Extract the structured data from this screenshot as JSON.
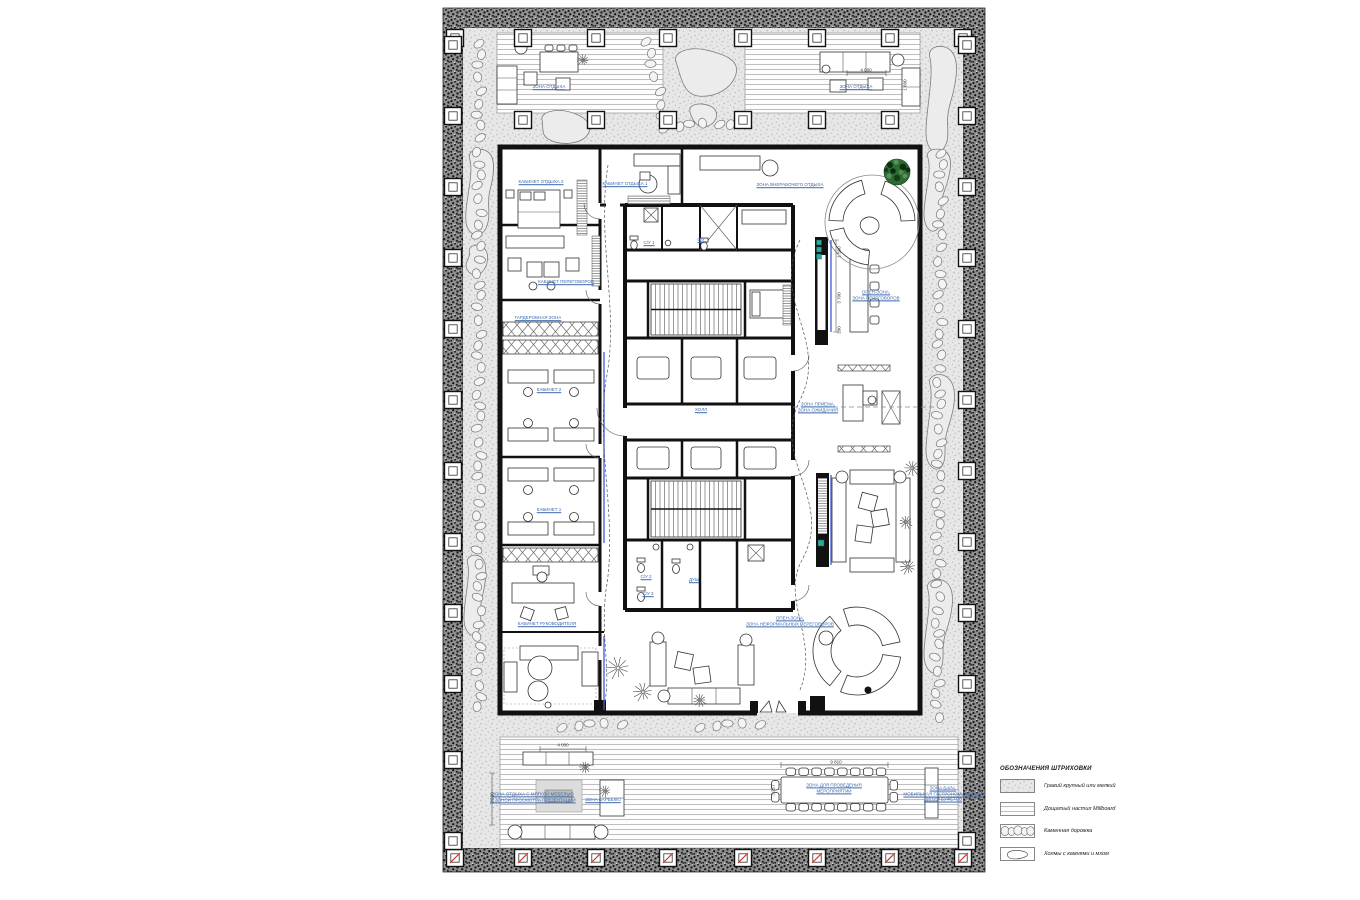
{
  "page": {
    "background": "#ffffff"
  },
  "colors": {
    "label_blue": "#3c69ae",
    "wall_black": "#111111",
    "tree_green": "#2c6b33",
    "column_mark_red": "#c3392b",
    "glass_blue": "#3f5bd6",
    "equipment_teal": "#2fa89a",
    "gravel_gray": "#e7e7e7",
    "band_dark": "#3a3a3a"
  },
  "legend": {
    "title": "ОБОЗНАЧЕНИЯ ШТРИХОВКИ",
    "items": [
      {
        "key": "gravel",
        "label": "Гравий крупный или мелкий"
      },
      {
        "key": "millboard",
        "label": "Дощатый настил Millboard"
      },
      {
        "key": "stone-path",
        "label": "Каменная дорожка"
      },
      {
        "key": "hills",
        "label": "Холмы с камнями и мхом"
      }
    ]
  },
  "plan": {
    "zone_labels": [
      {
        "text": "ЗОНА ОТДЫХА",
        "x": 549,
        "y": 87
      },
      {
        "text": "ЗОНА ОТДЫХА",
        "x": 856,
        "y": 87
      },
      {
        "text": "КАБИНЕТ ОТДЫХА 2",
        "x": 541,
        "y": 182
      },
      {
        "text": "КАБИНЕТ ОТДЫХА 1",
        "x": 625,
        "y": 184
      },
      {
        "text": "ЗОНА ВНЕРАБОЧЕГО ОТДЫХА",
        "x": 790,
        "y": 185
      },
      {
        "text": "КАБИНЕТ ПЕРЕГОВОРОВ",
        "x": 566,
        "y": 282
      },
      {
        "text": "ГАРДЕРОБНАЯ ЗОНА",
        "x": 538,
        "y": 318
      },
      {
        "text": "КАБИНЕТ 2",
        "x": 549,
        "y": 390
      },
      {
        "text": "КАБИНЕТ 1",
        "x": 549,
        "y": 510
      },
      {
        "text": "КАБИНЕТ РУКОВОДИТЕЛЯ",
        "x": 547,
        "y": 624
      },
      {
        "text": "ХОЛЛ",
        "x": 701,
        "y": 410
      },
      {
        "text": "ЗОНА ПРИЕМА,\nЗОНА ОЖИДАНИЯ",
        "x": 818,
        "y": 407
      },
      {
        "text": "ОПЕН-ЗОНА,\nЗОНА ПЕРЕГОВОРОВ",
        "x": 876,
        "y": 295
      },
      {
        "text": "С/У 1",
        "x": 649,
        "y": 243
      },
      {
        "text": "С/У",
        "x": 701,
        "y": 240
      },
      {
        "text": "С/У 2",
        "x": 646,
        "y": 577
      },
      {
        "text": "С/У 3",
        "x": 648,
        "y": 594
      },
      {
        "text": "ДУШ",
        "x": 694,
        "y": 580
      },
      {
        "text": "ОПЕН-ЗОНА,\nЗОНА НЕФОРМАЛЬНЫХ ПЕРЕГОВОРОВ",
        "x": 790,
        "y": 621
      },
      {
        "text": "ЗОНА ОТДЫХА С МЯГКОЙ МЕБЕЛЬЮ\nИ ЗОНОЙ ПРОСМОТРА ПРЕЗЕНТАЦИЙ",
        "x": 533,
        "y": 797
      },
      {
        "text": "ЗОНА БАРБЕКЮ",
        "x": 603,
        "y": 800
      },
      {
        "text": "ЗОНА ДЛЯ ПРОВЕДЕНИЯ\nМЕРОПРИЯТИЙ",
        "x": 834,
        "y": 788
      },
      {
        "text": "ЗОНА БАРА,\nМОБИЛЬНАЯ ГАСТРОНОМИЧЕСКАЯ\nЛИНИЯ БУФЕТОВ",
        "x": 943,
        "y": 794
      }
    ],
    "dimension_labels": [
      {
        "text": "4 000",
        "x": 563,
        "y": 745,
        "rot": 0
      },
      {
        "text": "9 810",
        "x": 836,
        "y": 762,
        "rot": 0
      },
      {
        "text": "4 000",
        "x": 866,
        "y": 70,
        "rot": 0
      },
      {
        "text": "1 600",
        "x": 905,
        "y": 85,
        "rot": 90
      },
      {
        "text": "3 257",
        "x": 773,
        "y": 790,
        "rot": 90
      },
      {
        "text": "2 280",
        "x": 492,
        "y": 798,
        "rot": 90
      },
      {
        "text": "1 500",
        "x": 839,
        "y": 252,
        "rot": 90
      },
      {
        "text": "3 700",
        "x": 839,
        "y": 298,
        "rot": 90
      },
      {
        "text": "200",
        "x": 839,
        "y": 330,
        "rot": 90
      }
    ]
  }
}
